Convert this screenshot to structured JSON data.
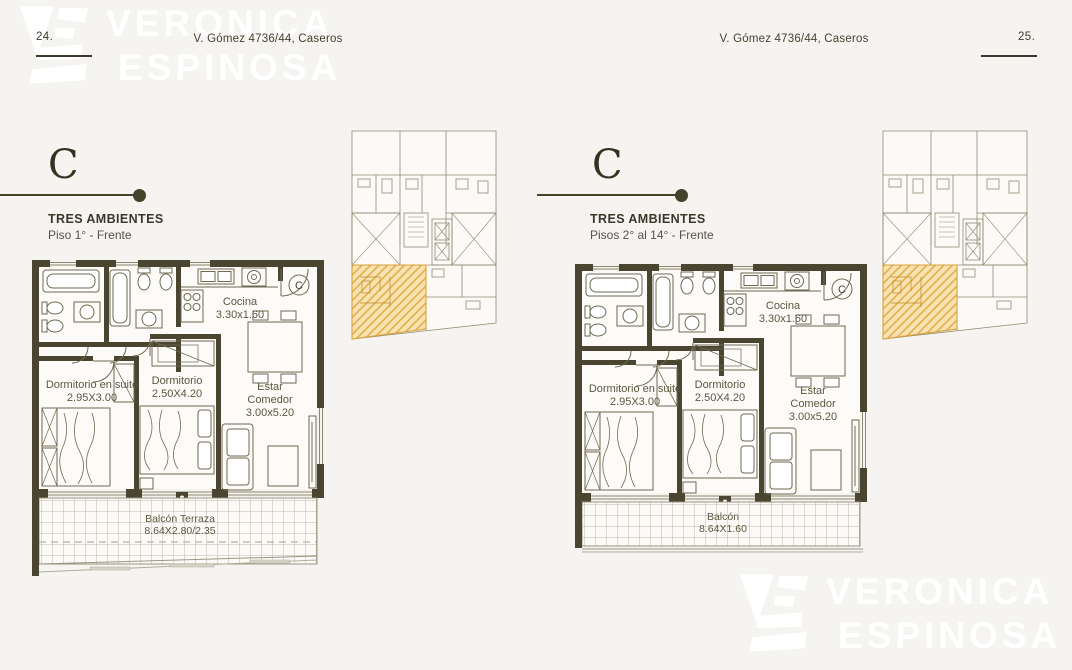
{
  "colors": {
    "background": "#f5f4f1",
    "wall": "#4a4530",
    "plan_line": "#6e6a52",
    "accent_olive": "#45422b",
    "text": "#3c3a2b",
    "balcony_grid": "#bdbaa9",
    "highlight_fill": "#f8e3b2",
    "highlight_stroke": "#d8a23b",
    "watermark": "#ffffff"
  },
  "watermark": {
    "word1": "VERONICA",
    "word2": "ESPINOSA"
  },
  "header": {
    "left_page_number": "24.",
    "right_page_number": "25.",
    "address": "V. Gómez 4736/44, Caseros"
  },
  "left_unit": {
    "letter": "C",
    "type": "TRES AMBIENTES",
    "floors": "Piso 1° - Frente",
    "entry_tag": "C",
    "rooms": {
      "cocina_name": "Cocina",
      "cocina_dims": "3.30x1.60",
      "suite_name": "Dormitorio en suite",
      "suite_dims": "2.95X3.00",
      "dorm_name": "Dormitorio",
      "dorm_dims": "2.50X4.20",
      "estar_name1": "Estar",
      "estar_name2": "Comedor",
      "estar_dims": "3.00x5.20",
      "balcon_name": "Balcón Terraza",
      "balcon_dims": "8.64X2.80/2.35"
    }
  },
  "right_unit": {
    "letter": "C",
    "type": "TRES AMBIENTES",
    "floors": "Pisos 2° al 14° - Frente",
    "entry_tag": "C",
    "rooms": {
      "cocina_name": "Cocina",
      "cocina_dims": "3.30x1.60",
      "suite_name": "Dormitorio en suite",
      "suite_dims": "2.95X3.00",
      "dorm_name": "Dormitorio",
      "dorm_dims": "2.50X4.20",
      "estar_name1": "Estar",
      "estar_name2": "Comedor",
      "estar_dims": "3.00x5.20",
      "balcon_name": "Balcón",
      "balcon_dims": "8.64X1.60"
    }
  }
}
